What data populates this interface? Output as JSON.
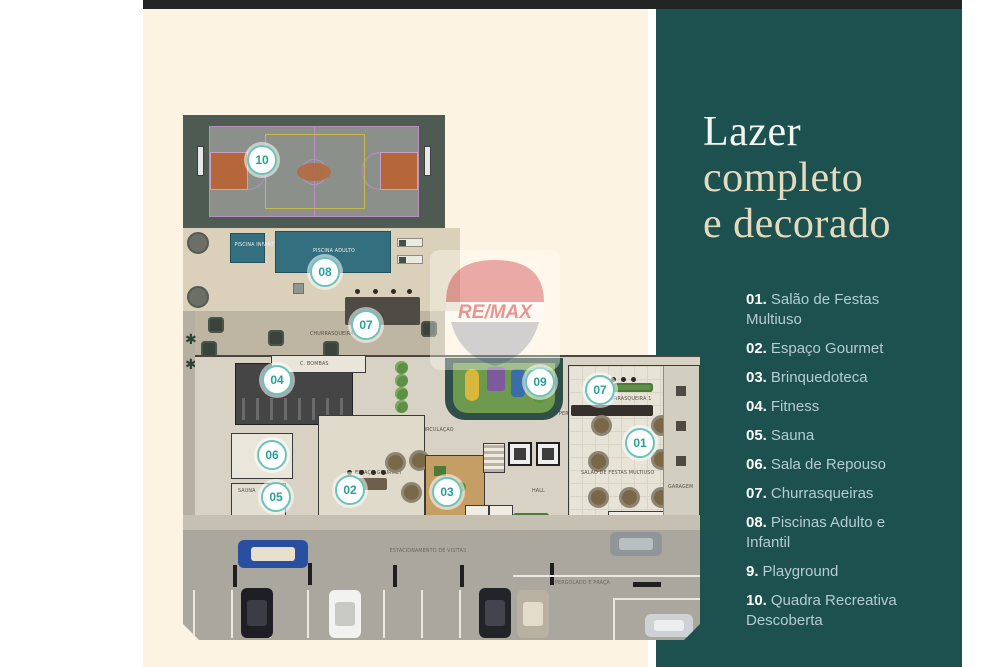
{
  "panel": {
    "background": "#1c5150",
    "title_line1": "Lazer",
    "title_line2": "completo",
    "title_line3": "e decorado",
    "items": [
      {
        "num": "01.",
        "label": "Salão de Festas Multiuso"
      },
      {
        "num": "02.",
        "label": "Espaço Gourmet"
      },
      {
        "num": "03.",
        "label": "Brinquedoteca"
      },
      {
        "num": "04.",
        "label": "Fitness"
      },
      {
        "num": "05.",
        "label": "Sauna"
      },
      {
        "num": "06.",
        "label": "Sala de Repouso"
      },
      {
        "num": "07.",
        "label": "Churrasqueiras"
      },
      {
        "num": "08.",
        "label": "Piscinas Adulto e Infantil"
      },
      {
        "num": "9.",
        "label": "Playground"
      },
      {
        "num": "10.",
        "label": "Quadra Recreativa Descoberta"
      }
    ]
  },
  "watermark": {
    "brand": "RE/MAX",
    "red": "#cf3a45",
    "blue": "#97a2b0"
  },
  "icons": {
    "tree_glyph": "✱"
  },
  "colors": {
    "cream": "#fdf3e3",
    "teal": "#1c5150",
    "marker_accent": "#27a099"
  },
  "plan": {
    "labels": {
      "piscina_adulto": "PISCINA ADULTO",
      "piscina_infantil": "PISCINA INFANTIL",
      "churrasqueira_2": "CHURRASQUEIRA 2",
      "churrasqueira_1": "CHURRASQUEIRA 1",
      "c_bombas": "C. BOMBAS",
      "circulacao": "CIRCULAÇÃO",
      "sauna": "SAUNA",
      "espaco_gourmet": "ESPAÇO GOURMET",
      "salao_festas": "SALÃO DE FESTAS MULTIUSO",
      "hall": "HALL",
      "garagem": "GARAGEM",
      "estacionamento": "ESTACIONAMENTO DE VISITAS",
      "pergolado": "PERGOLADO E PRAÇA"
    },
    "markers": [
      {
        "num": "10",
        "x": 64,
        "y": 30
      },
      {
        "num": "08",
        "x": 127,
        "y": 142
      },
      {
        "num": "07",
        "x": 168,
        "y": 195
      },
      {
        "num": "04",
        "x": 79,
        "y": 250
      },
      {
        "num": "09",
        "x": 342,
        "y": 252
      },
      {
        "num": "07",
        "x": 402,
        "y": 260
      },
      {
        "num": "01",
        "x": 442,
        "y": 313
      },
      {
        "num": "06",
        "x": 74,
        "y": 325
      },
      {
        "num": "02",
        "x": 152,
        "y": 360
      },
      {
        "num": "05",
        "x": 78,
        "y": 367
      },
      {
        "num": "03",
        "x": 249,
        "y": 362
      }
    ]
  }
}
